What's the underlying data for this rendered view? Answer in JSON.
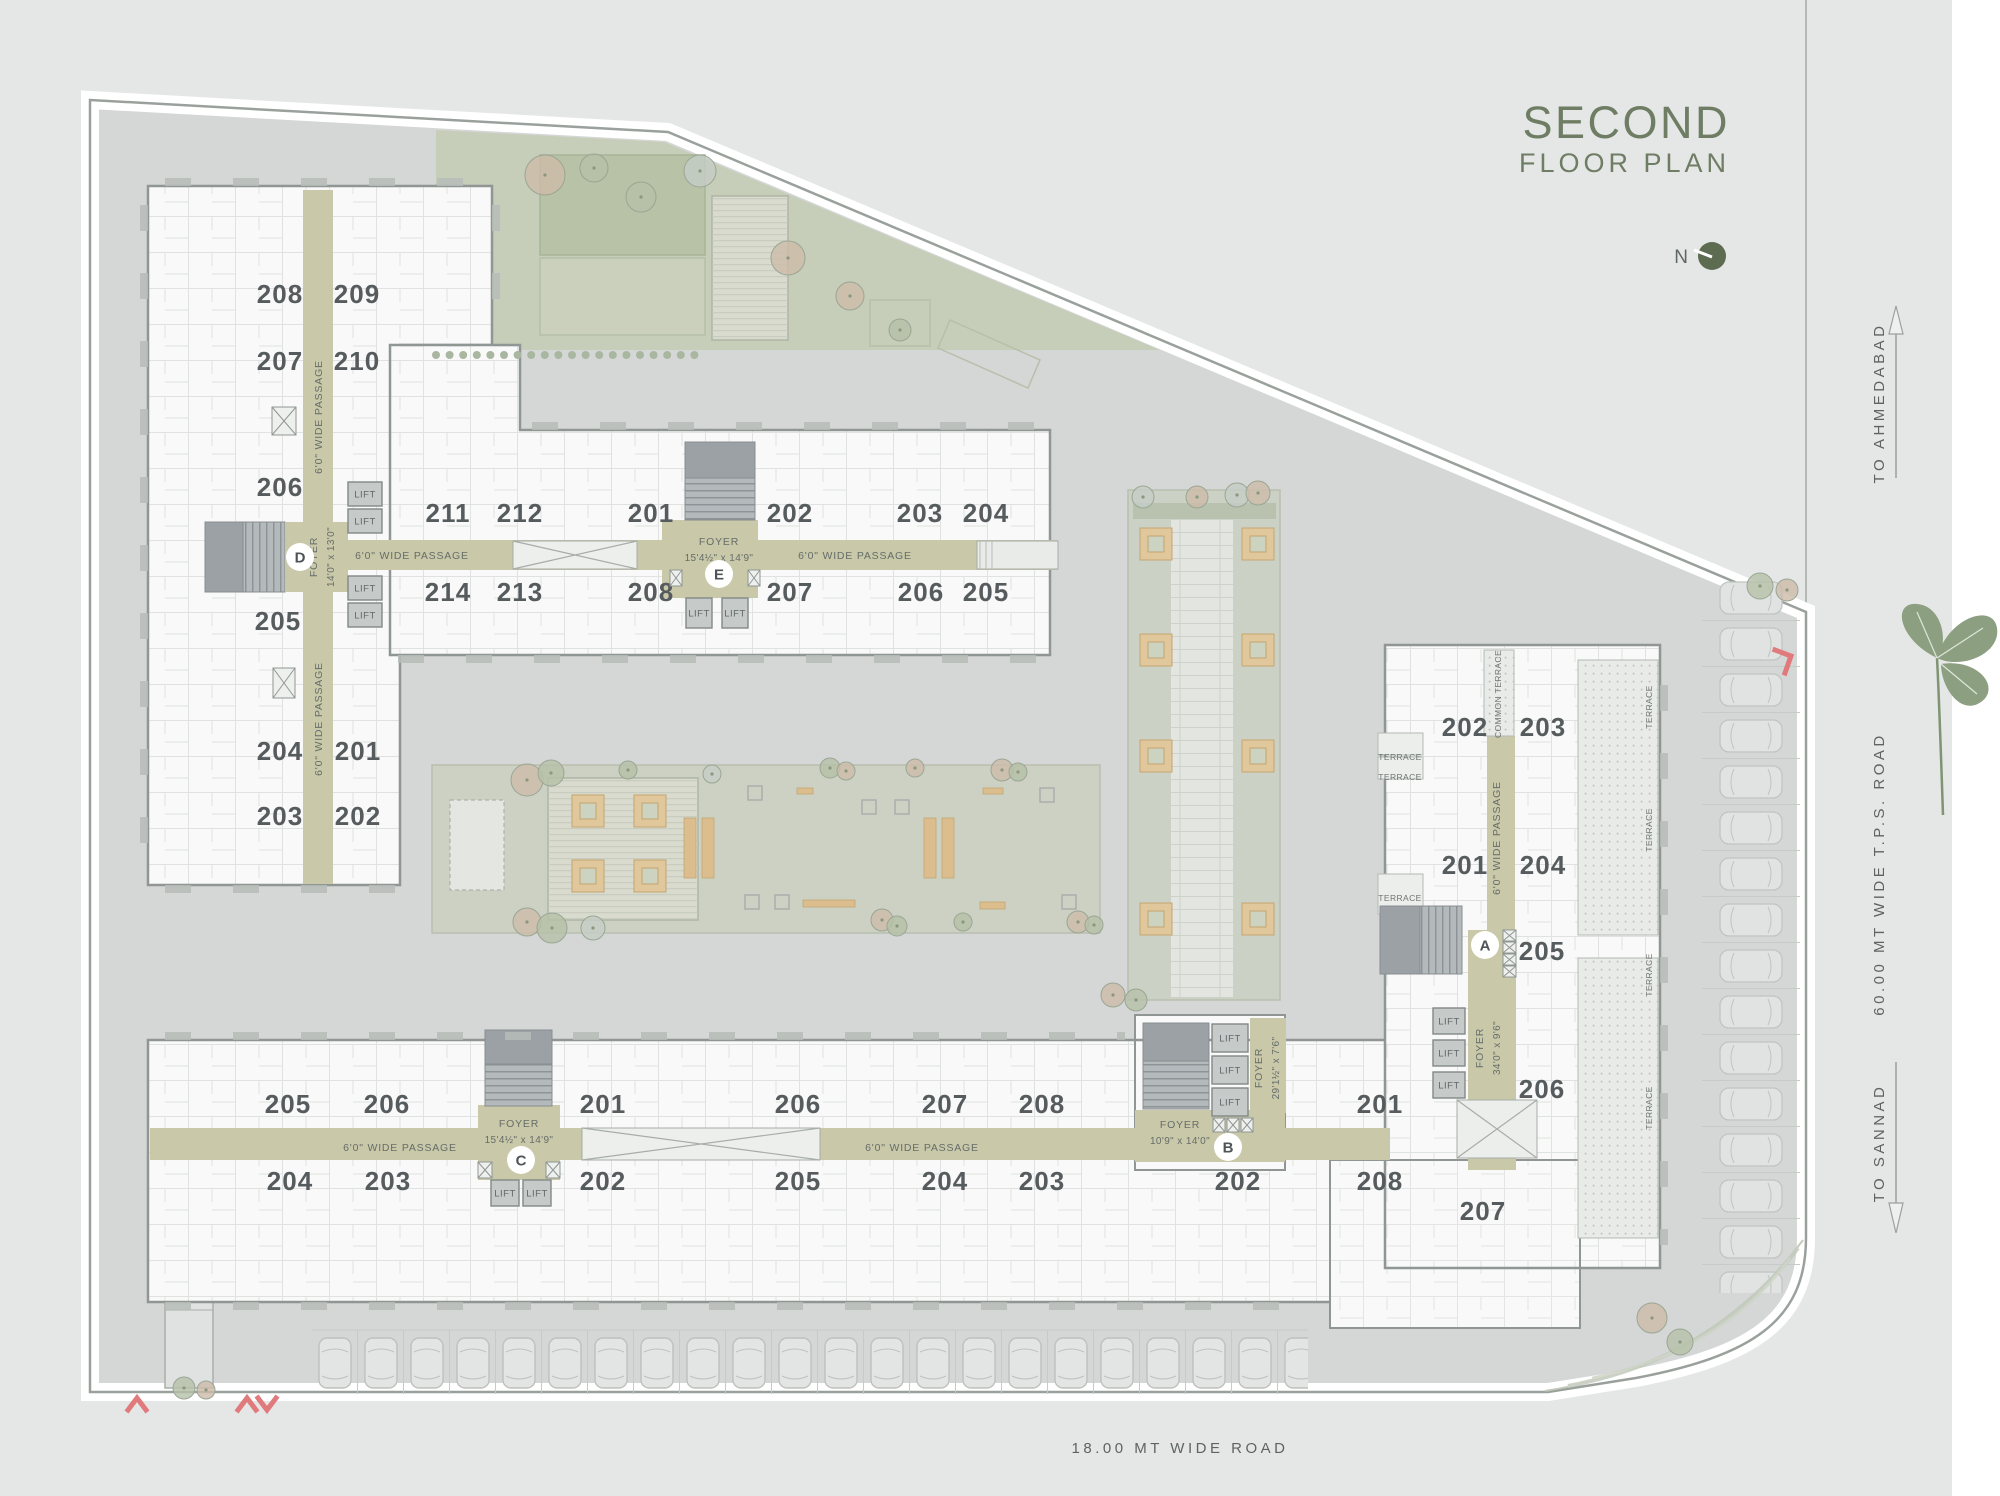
{
  "title": {
    "line1": "SECOND",
    "line2": "FLOOR PLAN"
  },
  "north_label": "N",
  "roads": {
    "to_ahmedabad": "TO AHMEDABAD",
    "tps_road": "60.00 MT WIDE T.P.S. ROAD",
    "to_sannad": "TO SANNAD",
    "bottom_road": "18.00 MT WIDE ROAD"
  },
  "labels": {
    "lift": "LIFT",
    "terrace": "TERRACE",
    "common_terrace": "COMMON TERRACE",
    "passage": "6'0\" WIDE PASSAGE",
    "foyer": "FOYER"
  },
  "blocks": {
    "d": {
      "marker": "D",
      "foyer_size": "14'0\" x 13'0\"",
      "units": [
        "208",
        "209",
        "207",
        "210",
        "206",
        "205",
        "204",
        "201",
        "203",
        "202"
      ]
    },
    "e": {
      "marker": "E",
      "foyer_size": "15'4½\" x 14'9\"",
      "units_top": [
        "211",
        "212",
        "201",
        "202",
        "203",
        "204"
      ],
      "units_bottom": [
        "214",
        "213",
        "208",
        "207",
        "206",
        "205"
      ]
    },
    "c": {
      "marker": "C",
      "foyer_size": "15'4½\" x 14'9\"",
      "units_top": [
        "205",
        "206",
        "201"
      ],
      "units_bottom": [
        "204",
        "203",
        "202"
      ]
    },
    "b": {
      "marker": "B",
      "foyer_main_size": "10'9\" x 14'0\"",
      "foyer_lift_size": "29'1½\" x 7'6\"",
      "units_top": [
        "206",
        "207",
        "208",
        "201"
      ],
      "units_bottom": [
        "205",
        "204",
        "203",
        "202",
        "208"
      ]
    },
    "a": {
      "marker": "A",
      "foyer_size": "34'0\" x 9'6\"",
      "units": [
        "202",
        "203",
        "201",
        "204",
        "205",
        "206",
        "207"
      ]
    }
  }
}
